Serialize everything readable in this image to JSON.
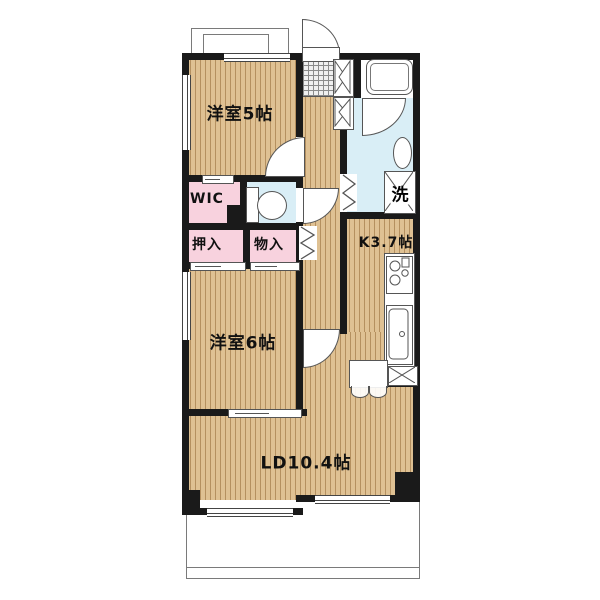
{
  "floorplan": {
    "rooms": {
      "bedroom5": {
        "label": "洋室5帖"
      },
      "bedroom6": {
        "label": "洋室6帖"
      },
      "living_dining": {
        "label": "LD10.4帖"
      },
      "kitchen": {
        "label": "K3.7帖"
      },
      "wic": {
        "label": "WIC"
      },
      "oshiire": {
        "label": "押入"
      },
      "monoire": {
        "label": "物入"
      },
      "laundry": {
        "label": "洗"
      }
    },
    "fixture_icons": [
      "entrance-door-icon",
      "bathtub-icon",
      "toilet-icon",
      "washbasin-icon",
      "washing-machine-icon",
      "gas-stove-icon",
      "kitchen-sink-icon",
      "refrigerator-cabinet-icon",
      "shoe-cabinet-icon",
      "folding-door-icon",
      "sliding-door-icon",
      "window-icon",
      "balcony-icon",
      "entrance-tile-icon",
      "pipe-space-icon"
    ],
    "colors": {
      "wood_floor": "#dfc193",
      "wood_stripe": "#926834",
      "closet_pink": "#f8d2de",
      "wet_area_blue": "#d9eef6",
      "wall_black": "#1a1a1a",
      "line_gray": "#555555"
    }
  }
}
